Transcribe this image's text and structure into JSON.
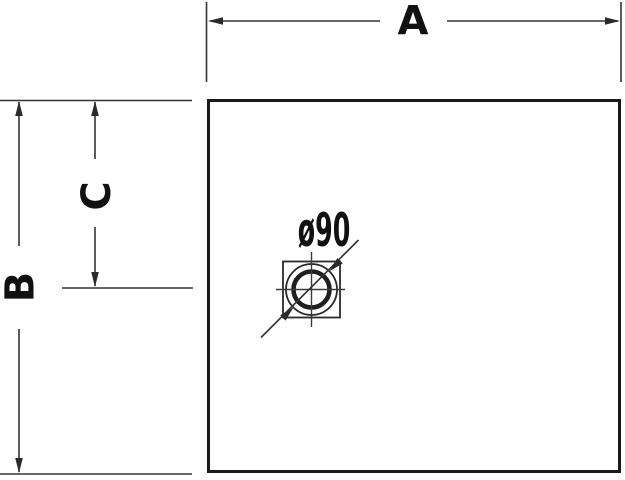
{
  "drawing": {
    "type": "technical-dimension-drawing",
    "background_color": "#ffffff",
    "line_color": "#333333",
    "outline_color": "#1a1a1a",
    "text_color": "#111111",
    "labels": {
      "width_dim": "A",
      "depth_dim": "B",
      "drain_offset_dim": "C",
      "drain_diameter": "ø90"
    }
  }
}
